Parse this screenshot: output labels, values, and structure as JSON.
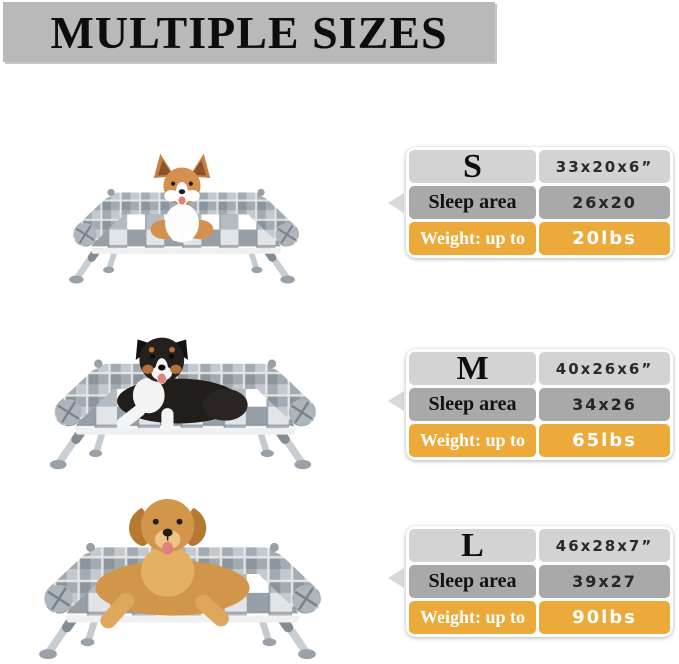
{
  "header": {
    "title": "MULTIPLE SIZES"
  },
  "colors": {
    "banner_bg": "#b9b9b9",
    "row_light_gray": "#d3d3d3",
    "row_mid_gray": "#a9a9a9",
    "accent_orange": "#ecaa3b",
    "arrow_gray": "#d9d9d9",
    "text_dark": "#111111",
    "text_white": "#ffffff"
  },
  "sizes": [
    {
      "size_label": "S",
      "dimensions": "33x20x6”",
      "sleep_area_label": "Sleep area",
      "sleep_area_value": "26x20",
      "weight_label": "Weight: up to",
      "weight_value": "20lbs",
      "photo": "corgi dog sitting on small elevated plaid dog bed"
    },
    {
      "size_label": "M",
      "dimensions": "40x26x6”",
      "sleep_area_label": "Sleep area",
      "sleep_area_value": "34x26",
      "weight_label": "Weight: up to",
      "weight_value": "65lbs",
      "photo": "australian shepherd lying on medium elevated plaid dog bed"
    },
    {
      "size_label": "L",
      "dimensions": "46x28x7”",
      "sleep_area_label": "Sleep area",
      "sleep_area_value": "39x27",
      "weight_label": "Weight: up to",
      "weight_value": "90lbs",
      "photo": "golden retriever lying on large elevated plaid dog bed"
    }
  ]
}
